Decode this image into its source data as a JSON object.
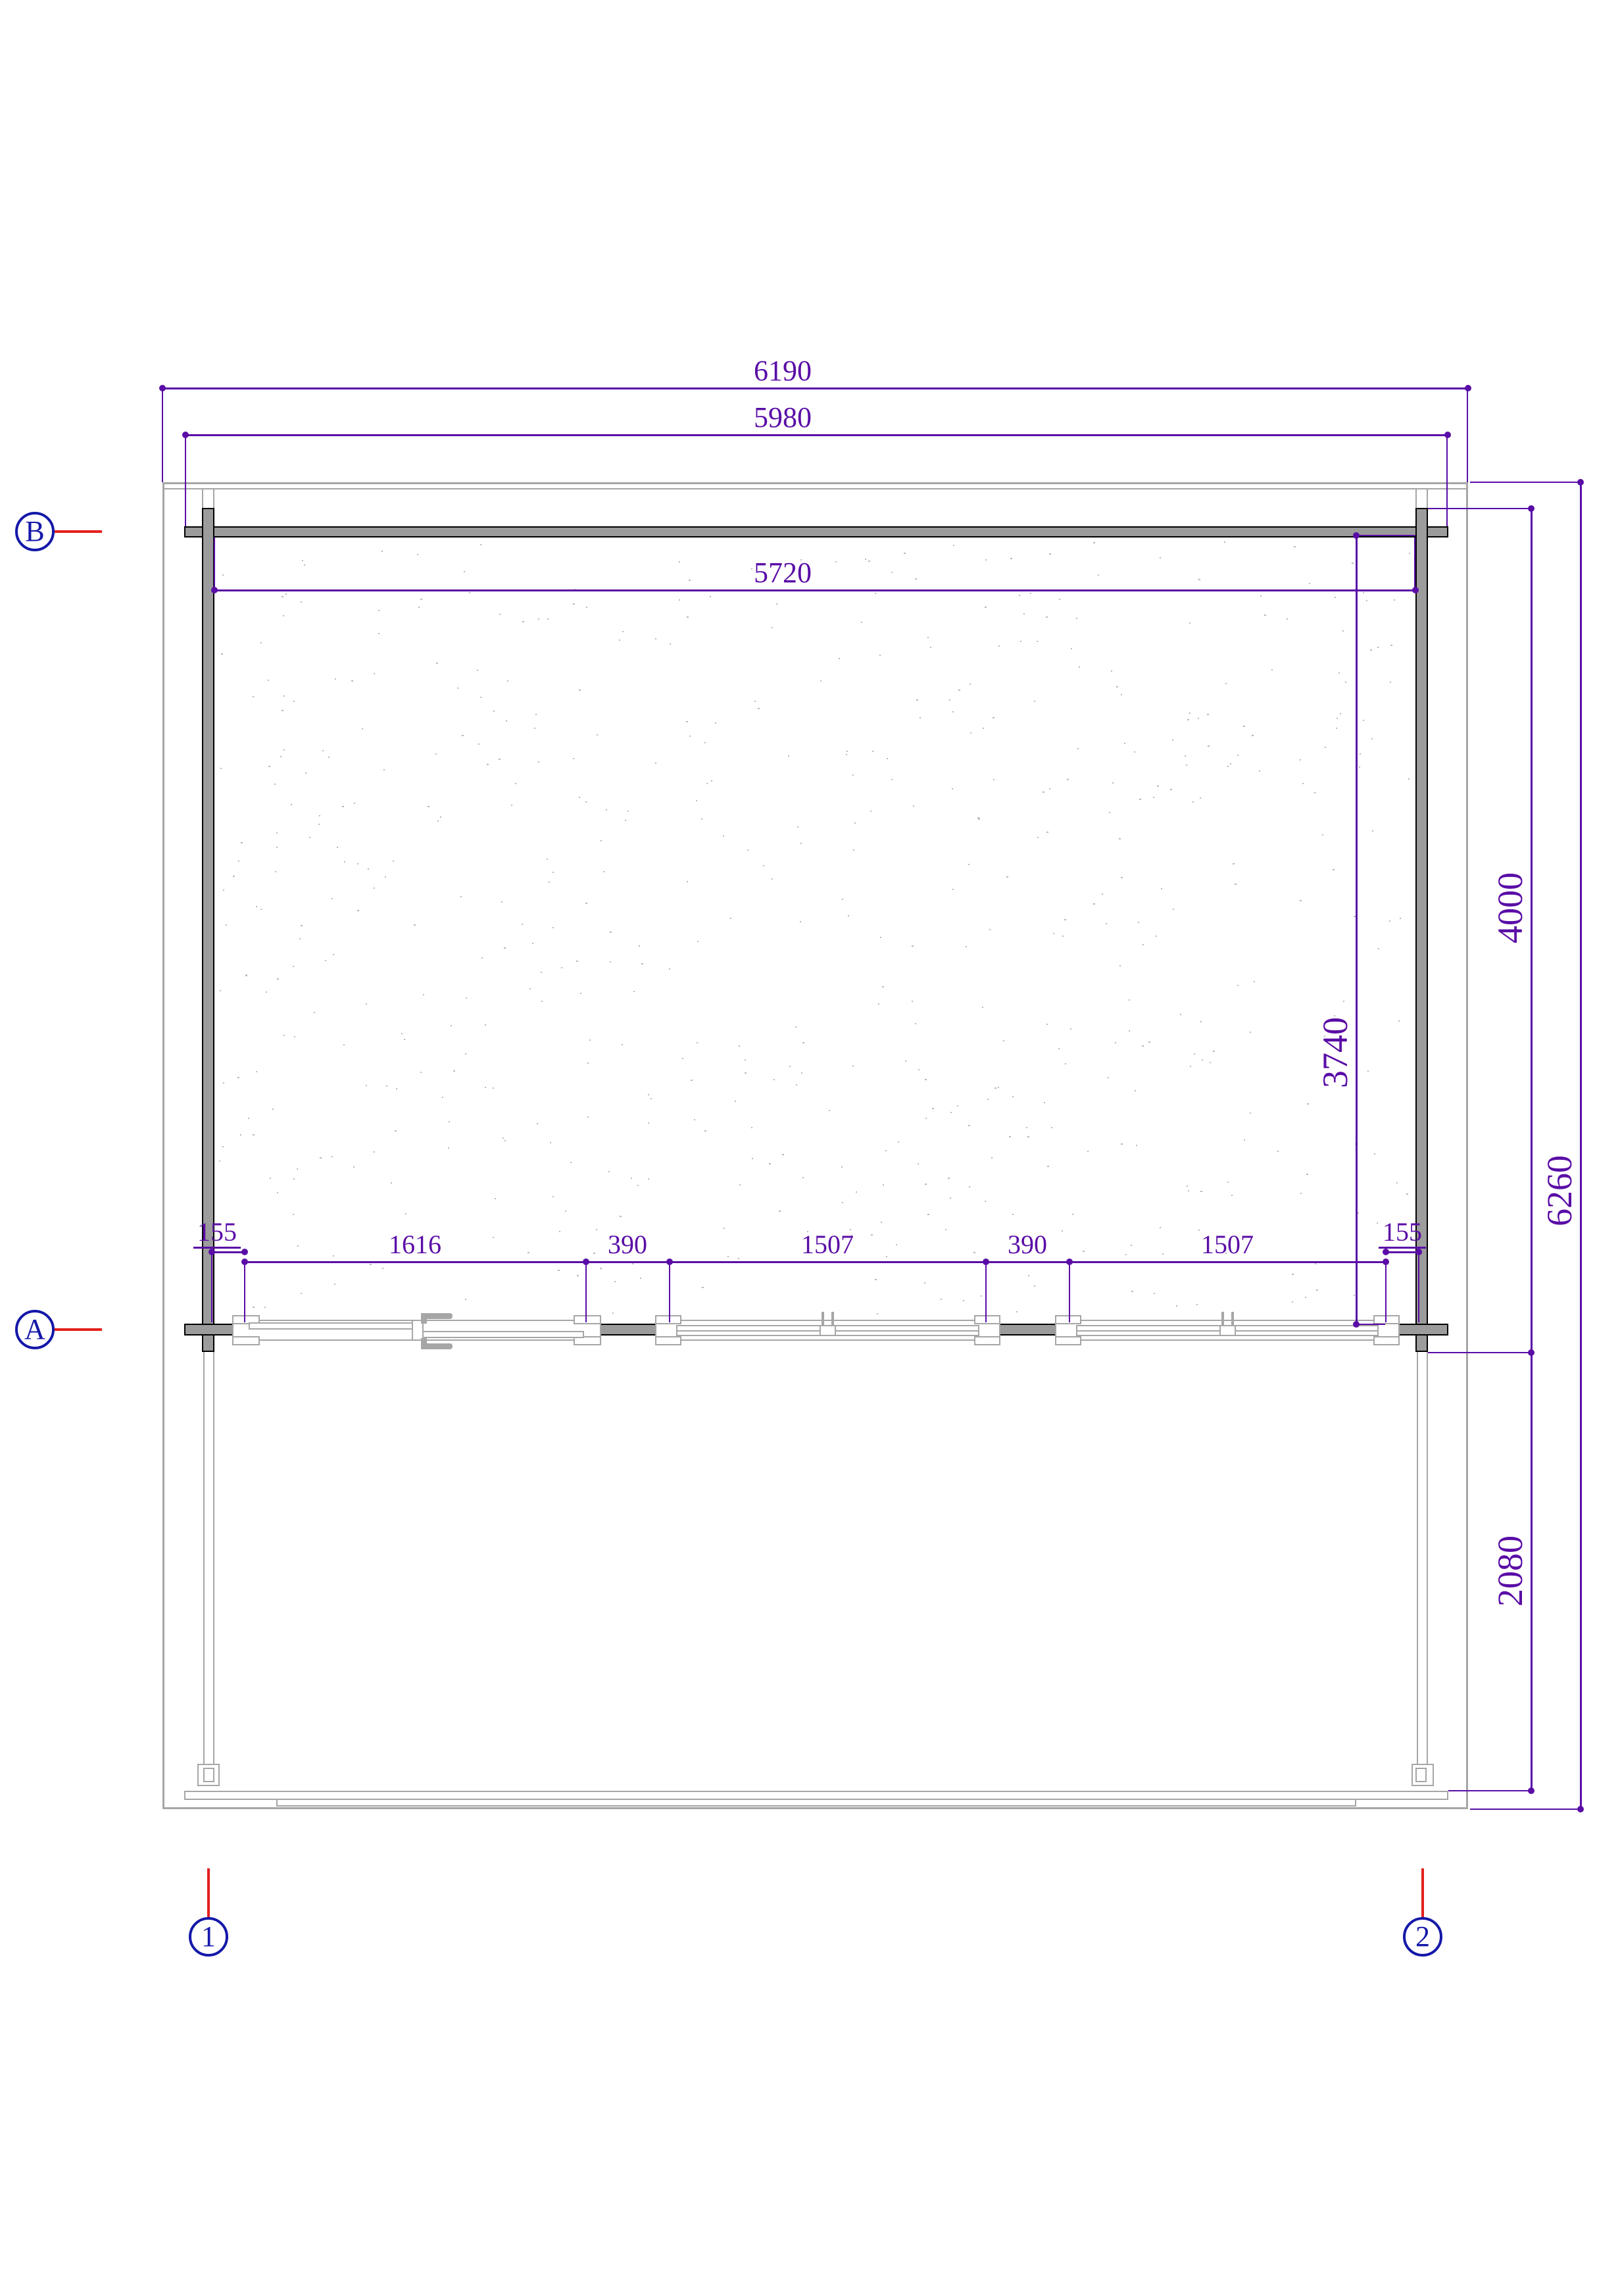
{
  "colors": {
    "dimension": "#5a0da6",
    "axis": "#1418a8",
    "leader": "#e3201b",
    "wall_fill": "#9c9c9c",
    "structure": "#a6a6a6"
  },
  "dimensions": {
    "overall_width": "6190",
    "log_width": "5980",
    "interior_width": "5720",
    "chain": [
      "155",
      "1616",
      "390",
      "1507",
      "390",
      "1507",
      "155"
    ],
    "interior_depth": "3740",
    "log_depth": "4000",
    "overall_depth": "6260",
    "terrace_depth": "2080"
  },
  "axes": {
    "row_top": "B",
    "row_bottom": "A",
    "col_left": "1",
    "col_right": "2"
  }
}
